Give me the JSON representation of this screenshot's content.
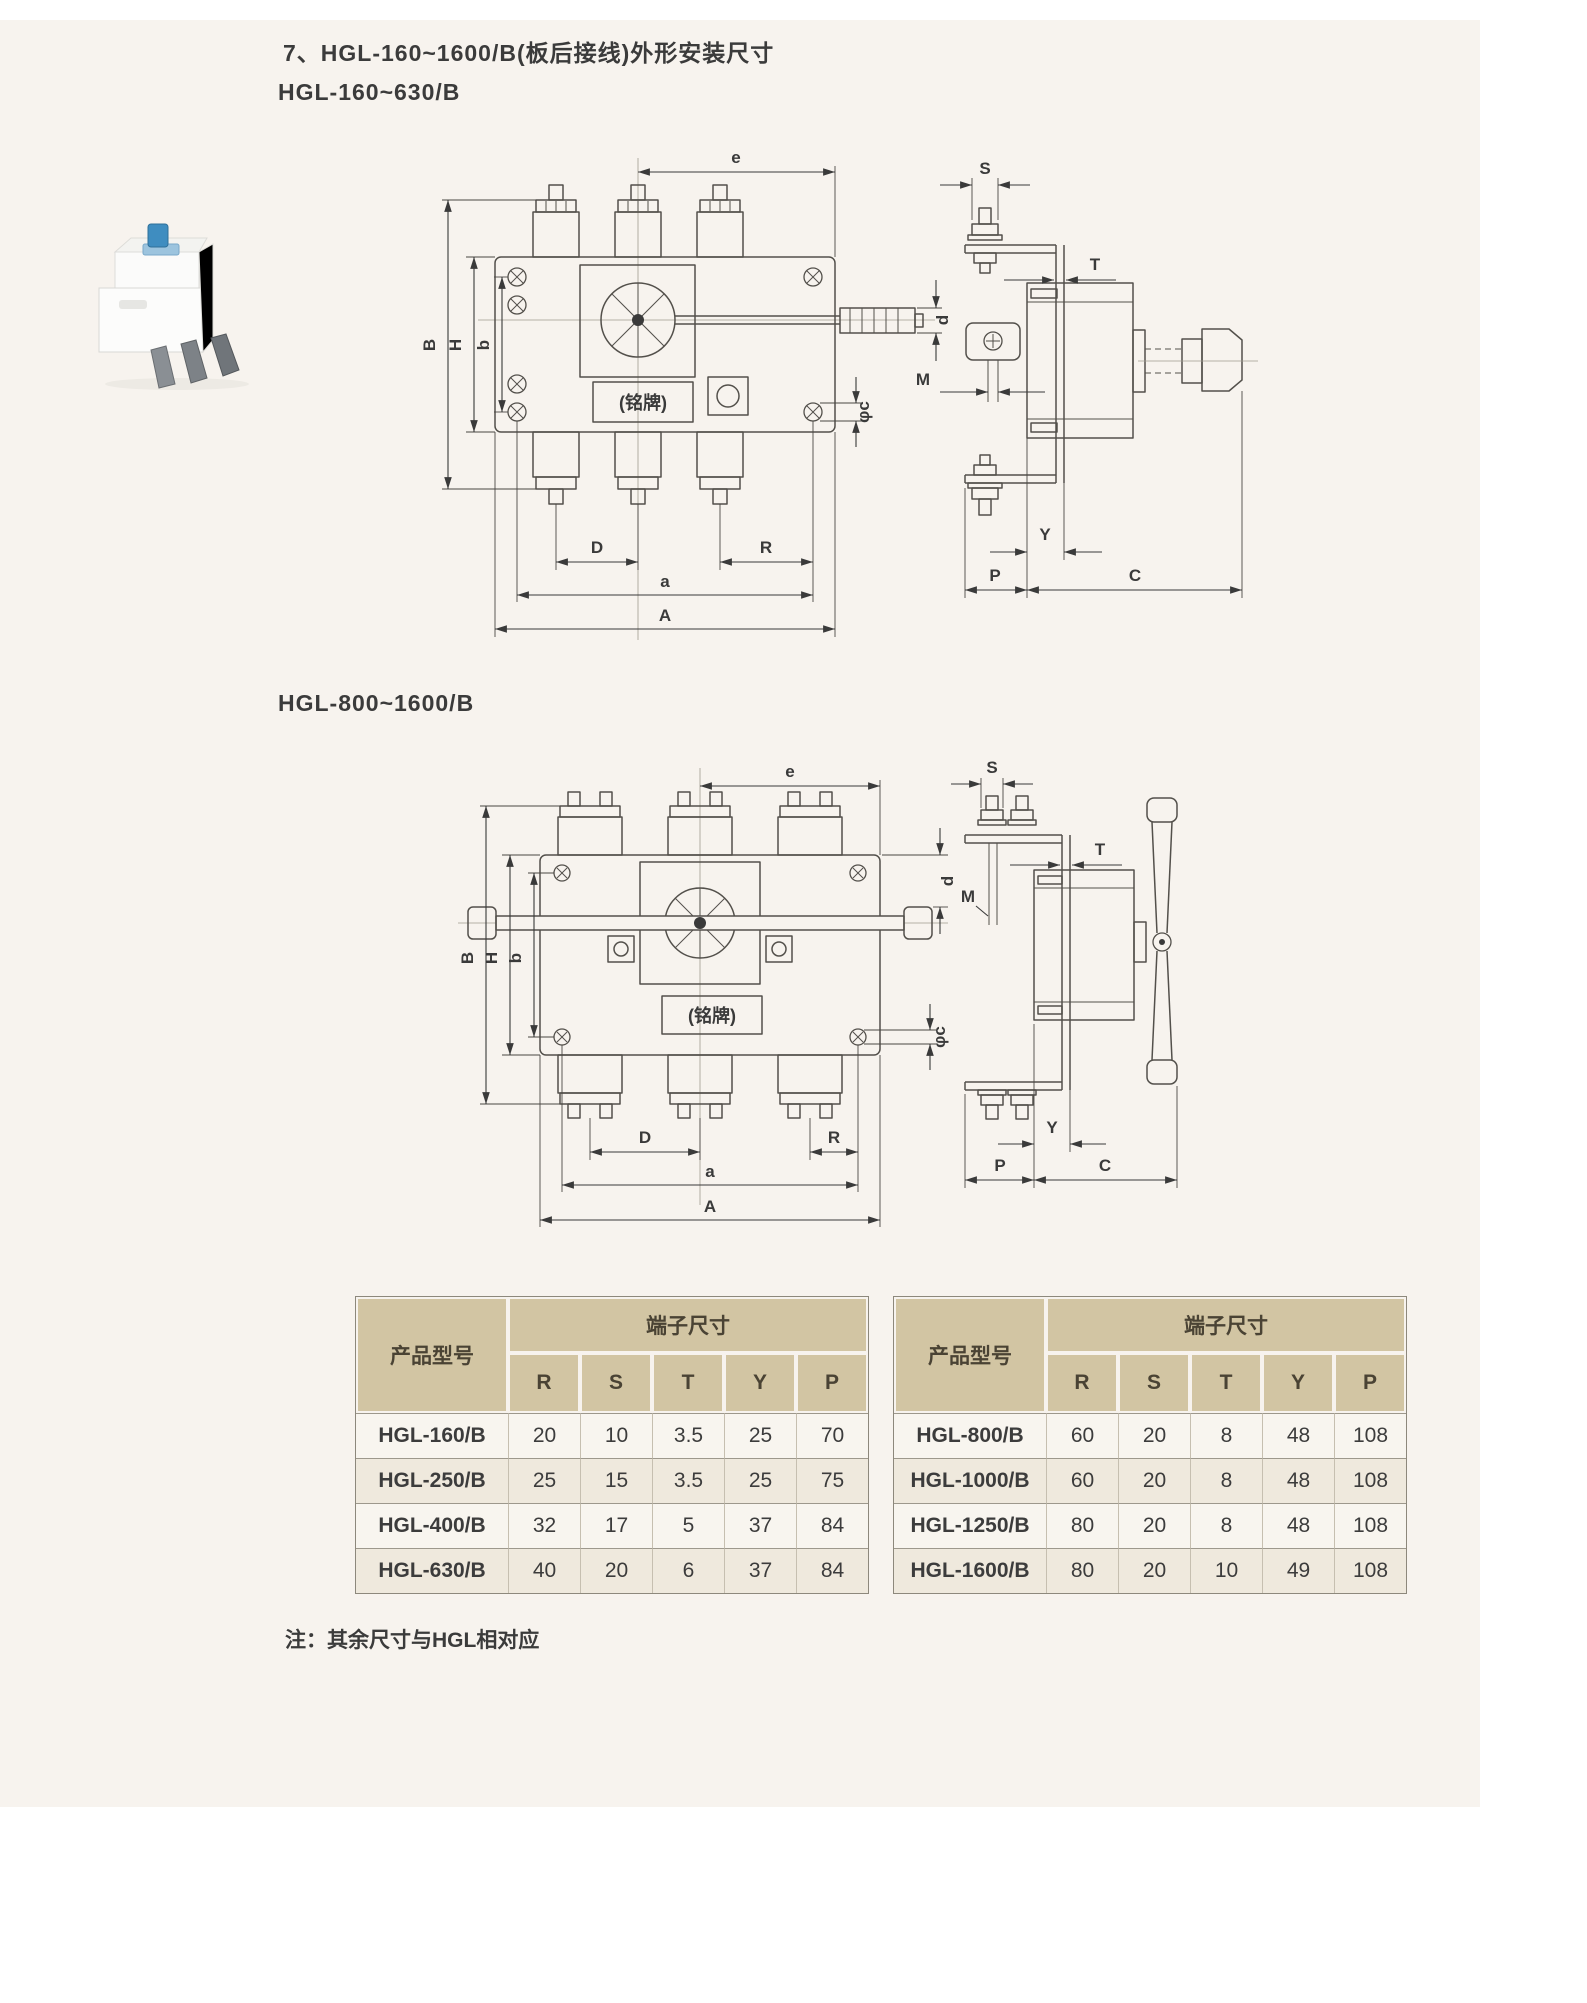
{
  "page": {
    "title": "7、HGL-160~1600/B(板后接线)外形安装尺寸",
    "section1_title": "HGL-160~630/B",
    "section2_title": "HGL-800~1600/B",
    "note": "注：其余尺寸与HGL相对应",
    "nameplate_label": "(铭牌)"
  },
  "dims": {
    "e": "e",
    "S": "S",
    "T": "T",
    "d": "d",
    "M": "M",
    "phi_c": "φc",
    "B": "B",
    "H": "H",
    "b": "b",
    "D": "D",
    "R": "R",
    "a": "a",
    "A": "A",
    "Y": "Y",
    "P": "P",
    "C": "C"
  },
  "tables": [
    {
      "product_col": "产品型号",
      "terminal_header": "端子尺寸",
      "columns": [
        "R",
        "S",
        "T",
        "Y",
        "P"
      ],
      "rows": [
        {
          "model": "HGL-160/B",
          "values": [
            "20",
            "10",
            "3.5",
            "25",
            "70"
          ]
        },
        {
          "model": "HGL-250/B",
          "values": [
            "25",
            "15",
            "3.5",
            "25",
            "75"
          ]
        },
        {
          "model": "HGL-400/B",
          "values": [
            "32",
            "17",
            "5",
            "37",
            "84"
          ]
        },
        {
          "model": "HGL-630/B",
          "values": [
            "40",
            "20",
            "6",
            "37",
            "84"
          ]
        }
      ]
    },
    {
      "product_col": "产品型号",
      "terminal_header": "端子尺寸",
      "columns": [
        "R",
        "S",
        "T",
        "Y",
        "P"
      ],
      "rows": [
        {
          "model": "HGL-800/B",
          "values": [
            "60",
            "20",
            "8",
            "48",
            "108"
          ]
        },
        {
          "model": "HGL-1000/B",
          "values": [
            "60",
            "20",
            "8",
            "48",
            "108"
          ]
        },
        {
          "model": "HGL-1250/B",
          "values": [
            "80",
            "20",
            "8",
            "48",
            "108"
          ]
        },
        {
          "model": "HGL-1600/B",
          "values": [
            "80",
            "20",
            "10",
            "49",
            "108"
          ]
        }
      ]
    }
  ],
  "colors": {
    "page_bg": "#ffffff",
    "panel_bg": "#f7f3ee",
    "table_header_bg": "#d2c5a3",
    "drawing_line": "#53504b",
    "text": "#3b3b3b",
    "knob_blue": "#3f8dc0"
  }
}
